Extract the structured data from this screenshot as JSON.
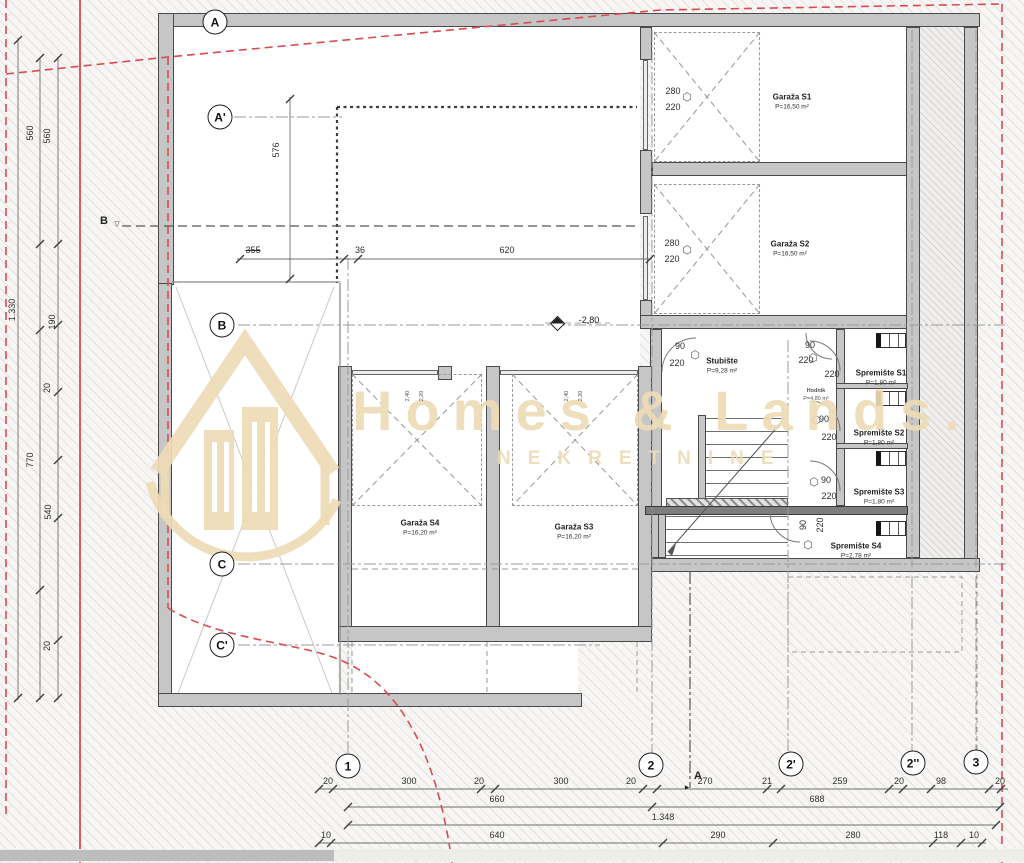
{
  "title": "Garage level floor plan",
  "watermark": {
    "title": "Homes & Lands.",
    "subtitle": "NEKRETNINE",
    "color": "#eedbb5"
  },
  "colors": {
    "boundary_red": "#d94b52",
    "wall_gray": "#c6c6c6",
    "line_dark": "#3c3c3c",
    "watermark_tan": "#eedbb5"
  },
  "level_marker": {
    "text": "-2,80"
  },
  "axes": {
    "left": [
      {
        "label": "A",
        "x": 215,
        "y": 22
      },
      {
        "label": "A'",
        "x": 220,
        "y": 117
      },
      {
        "label": "B",
        "x": 222,
        "y": 325
      },
      {
        "label": "C",
        "x": 222,
        "y": 564
      },
      {
        "label": "C'",
        "x": 222,
        "y": 645
      }
    ],
    "bottom": [
      {
        "label": "1",
        "x": 348,
        "y": 766
      },
      {
        "label": "2",
        "x": 651,
        "y": 765
      },
      {
        "label": "2'",
        "x": 791,
        "y": 764
      },
      {
        "label": "2''",
        "x": 913,
        "y": 763
      },
      {
        "label": "3",
        "x": 976,
        "y": 762
      }
    ]
  },
  "section_markers": [
    {
      "label": "B",
      "tri": "▽",
      "x": 104,
      "y": 221,
      "tx": 117,
      "ty": 224
    },
    {
      "label": "A",
      "tri": "►",
      "x": 698,
      "y": 776,
      "tx": 687,
      "ty": 788
    }
  ],
  "rooms": [
    {
      "name": "Garaža S1",
      "area": "P=16,50 m²",
      "x": 792,
      "y": 97
    },
    {
      "name": "Garaža S2",
      "area": "P=16,50 m²",
      "x": 790,
      "y": 244
    },
    {
      "name": "Garaža S4",
      "area": "P=16,20 m²",
      "x": 420,
      "y": 523
    },
    {
      "name": "Garaža S3",
      "area": "P=16,20 m²",
      "x": 574,
      "y": 527
    },
    {
      "name": "Stubište",
      "area": "P=9,28 m²",
      "x": 722,
      "y": 361
    },
    {
      "name": "Hodnik",
      "area": "P=4,80 m²",
      "x": 816,
      "y": 391,
      "small": true
    },
    {
      "name": "Spremište S1",
      "area": "P=1,80 m²",
      "x": 881,
      "y": 373
    },
    {
      "name": "Spremište S2",
      "area": "P=1,80 m²",
      "x": 879,
      "y": 433
    },
    {
      "name": "Spremište S3",
      "area": "P=1,80 m²",
      "x": 879,
      "y": 492
    },
    {
      "name": "Spremište S4",
      "area": "P=2,78 m²",
      "x": 856,
      "y": 546
    }
  ],
  "dims": [
    {
      "t": "560",
      "x": 30,
      "y": 133,
      "r": -90
    },
    {
      "t": "560",
      "x": 47,
      "y": 136,
      "r": -90
    },
    {
      "t": "1.330",
      "x": 12,
      "y": 310,
      "r": -90
    },
    {
      "t": "190",
      "x": 52,
      "y": 322,
      "r": -90
    },
    {
      "t": "20",
      "x": 47,
      "y": 388,
      "r": -90
    },
    {
      "t": "770",
      "x": 30,
      "y": 460,
      "r": -90
    },
    {
      "t": "540",
      "x": 48,
      "y": 512,
      "r": -90
    },
    {
      "t": "20",
      "x": 47,
      "y": 646,
      "r": -90
    },
    {
      "t": "576",
      "x": 276,
      "y": 150,
      "r": -90
    },
    {
      "t": "355",
      "x": 253,
      "y": 250,
      "s": "strike"
    },
    {
      "t": "36",
      "x": 360,
      "y": 250
    },
    {
      "t": "620",
      "x": 507,
      "y": 250
    },
    {
      "t": "280",
      "x": 673,
      "y": 91
    },
    {
      "t": "220",
      "x": 673,
      "y": 107
    },
    {
      "t": "280",
      "x": 672,
      "y": 243
    },
    {
      "t": "220",
      "x": 672,
      "y": 259
    },
    {
      "t": "90",
      "x": 680,
      "y": 346
    },
    {
      "t": "220",
      "x": 677,
      "y": 363
    },
    {
      "t": "90",
      "x": 810,
      "y": 345
    },
    {
      "t": "220",
      "x": 806,
      "y": 360
    },
    {
      "t": "220",
      "x": 832,
      "y": 374
    },
    {
      "t": "90",
      "x": 824,
      "y": 419
    },
    {
      "t": "220",
      "x": 829,
      "y": 437
    },
    {
      "t": "90",
      "x": 826,
      "y": 480
    },
    {
      "t": "220",
      "x": 829,
      "y": 496
    },
    {
      "t": "90",
      "x": 803,
      "y": 525,
      "r": -90
    },
    {
      "t": "220",
      "x": 820,
      "y": 525,
      "r": -90
    },
    {
      "t": "2,40",
      "x": 408,
      "y": 396,
      "r": -90,
      "s": "tiny"
    },
    {
      "t": "2,20",
      "x": 422,
      "y": 396,
      "r": -90,
      "s": "tiny"
    },
    {
      "t": "2,40",
      "x": 567,
      "y": 396,
      "r": -90,
      "s": "tiny"
    },
    {
      "t": "2,20",
      "x": 581,
      "y": 396,
      "r": -90,
      "s": "tiny"
    },
    {
      "t": "20",
      "x": 328,
      "y": 781
    },
    {
      "t": "300",
      "x": 409,
      "y": 781
    },
    {
      "t": "20",
      "x": 479,
      "y": 781
    },
    {
      "t": "300",
      "x": 561,
      "y": 781
    },
    {
      "t": "20",
      "x": 631,
      "y": 781
    },
    {
      "t": "270",
      "x": 705,
      "y": 781
    },
    {
      "t": "21",
      "x": 767,
      "y": 781
    },
    {
      "t": "259",
      "x": 840,
      "y": 781
    },
    {
      "t": "20",
      "x": 899,
      "y": 781
    },
    {
      "t": "98",
      "x": 941,
      "y": 781
    },
    {
      "t": "20",
      "x": 1000,
      "y": 781
    },
    {
      "t": "660",
      "x": 497,
      "y": 799
    },
    {
      "t": "688",
      "x": 817,
      "y": 799
    },
    {
      "t": "1.348",
      "x": 663,
      "y": 817
    },
    {
      "t": "10",
      "x": 326,
      "y": 835
    },
    {
      "t": "640",
      "x": 497,
      "y": 835
    },
    {
      "t": "290",
      "x": 718,
      "y": 835
    },
    {
      "t": "280",
      "x": 853,
      "y": 835
    },
    {
      "t": "118",
      "x": 941,
      "y": 835
    },
    {
      "t": "10",
      "x": 974,
      "y": 835
    }
  ]
}
